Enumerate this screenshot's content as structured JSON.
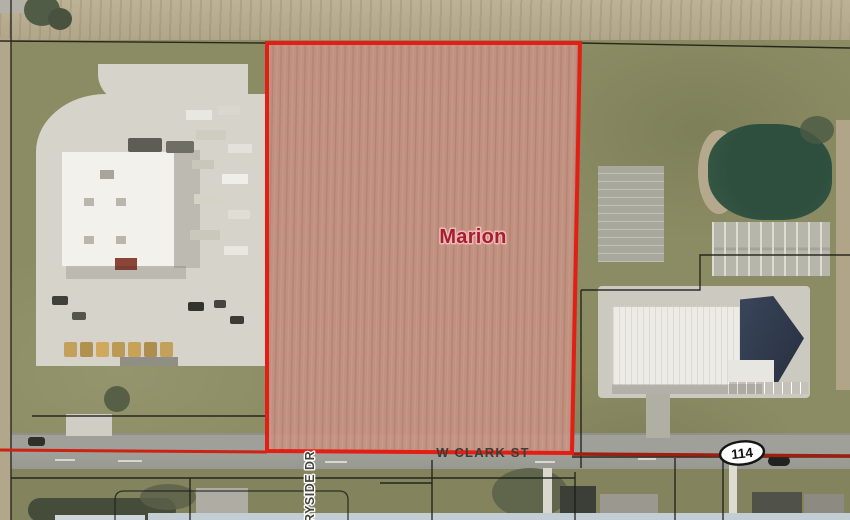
{
  "map": {
    "labels": {
      "parcel": "Marion",
      "main_street": "W CLARK ST",
      "side_street": "RYSIDE DR",
      "route": "114"
    },
    "colors": {
      "parcel_outline": "#e31e14",
      "parcel_fill": "#c69182",
      "parcel_label": "#a3202e",
      "road_line_west": "#cc2314",
      "road_line_east": "#9c2012",
      "route_shield_fill": "#ffffff",
      "route_shield_border": "#141414"
    }
  }
}
